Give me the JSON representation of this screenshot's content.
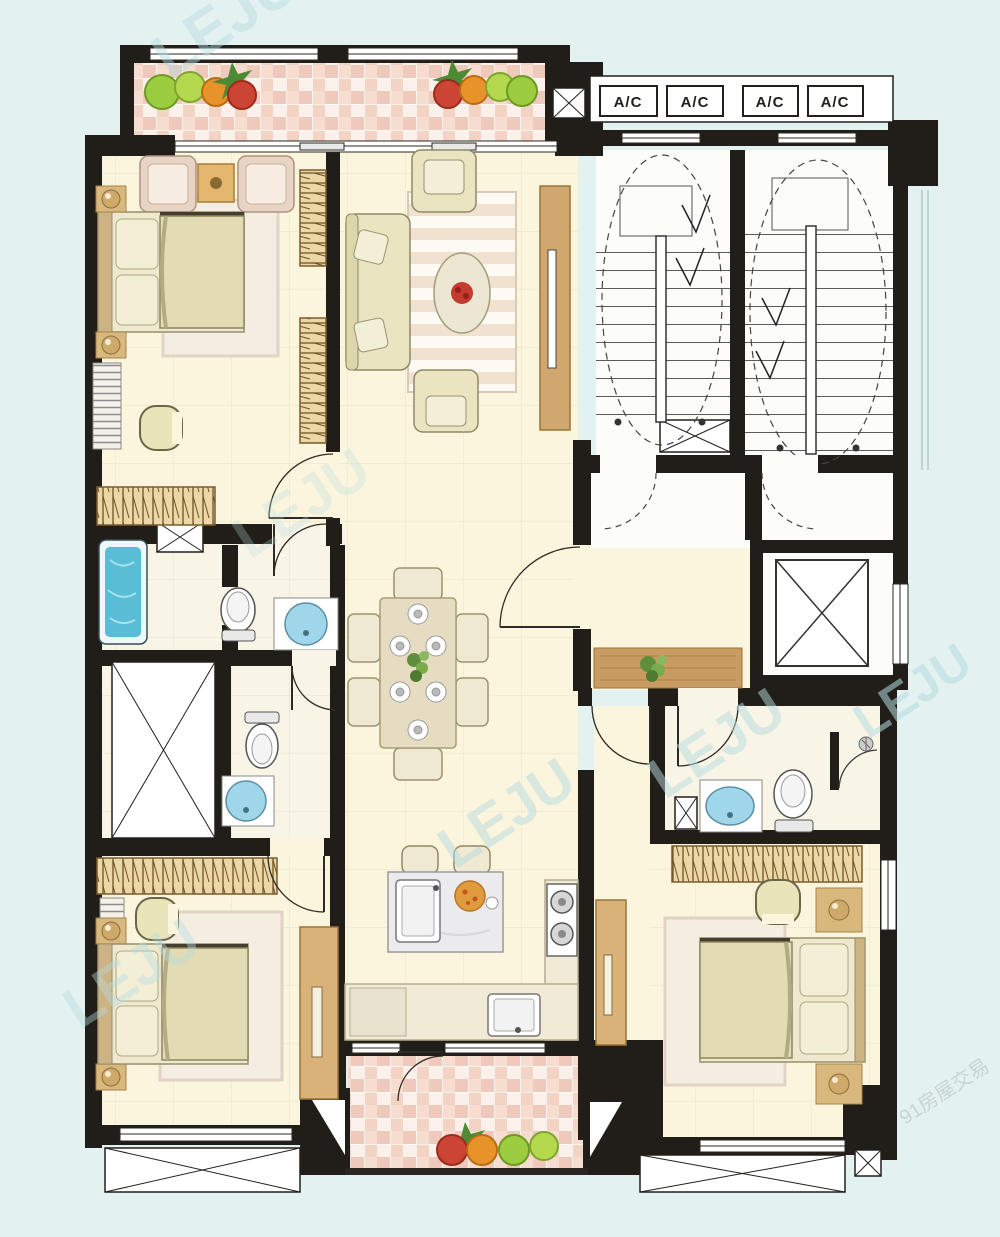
{
  "document": {
    "type": "apartment-floor-plan"
  },
  "colors": {
    "background": "#e3f1f0",
    "wall": "#211d18",
    "floor_cream": "#faf5dc",
    "floor_grid": "#eae2cb",
    "balcony_tile_base": "#f8e9e1",
    "balcony_tile_dark": "#f1cdbd",
    "wood": "#cfa76f",
    "furniture_cream": "#eae4c0",
    "rug": "#f4eee2",
    "bathtub_blue": "#59bdd6",
    "sink_blue": "#9fd6e9",
    "marble": "#ebebee",
    "stair_floor": "#fcfcf9",
    "watermark": "#b7dde0"
  },
  "ac_units": {
    "labels": [
      "A/C",
      "A/C",
      "A/C",
      "A/C"
    ]
  },
  "watermark": {
    "text": "LEJU",
    "corner_text": "91房屋交易"
  }
}
